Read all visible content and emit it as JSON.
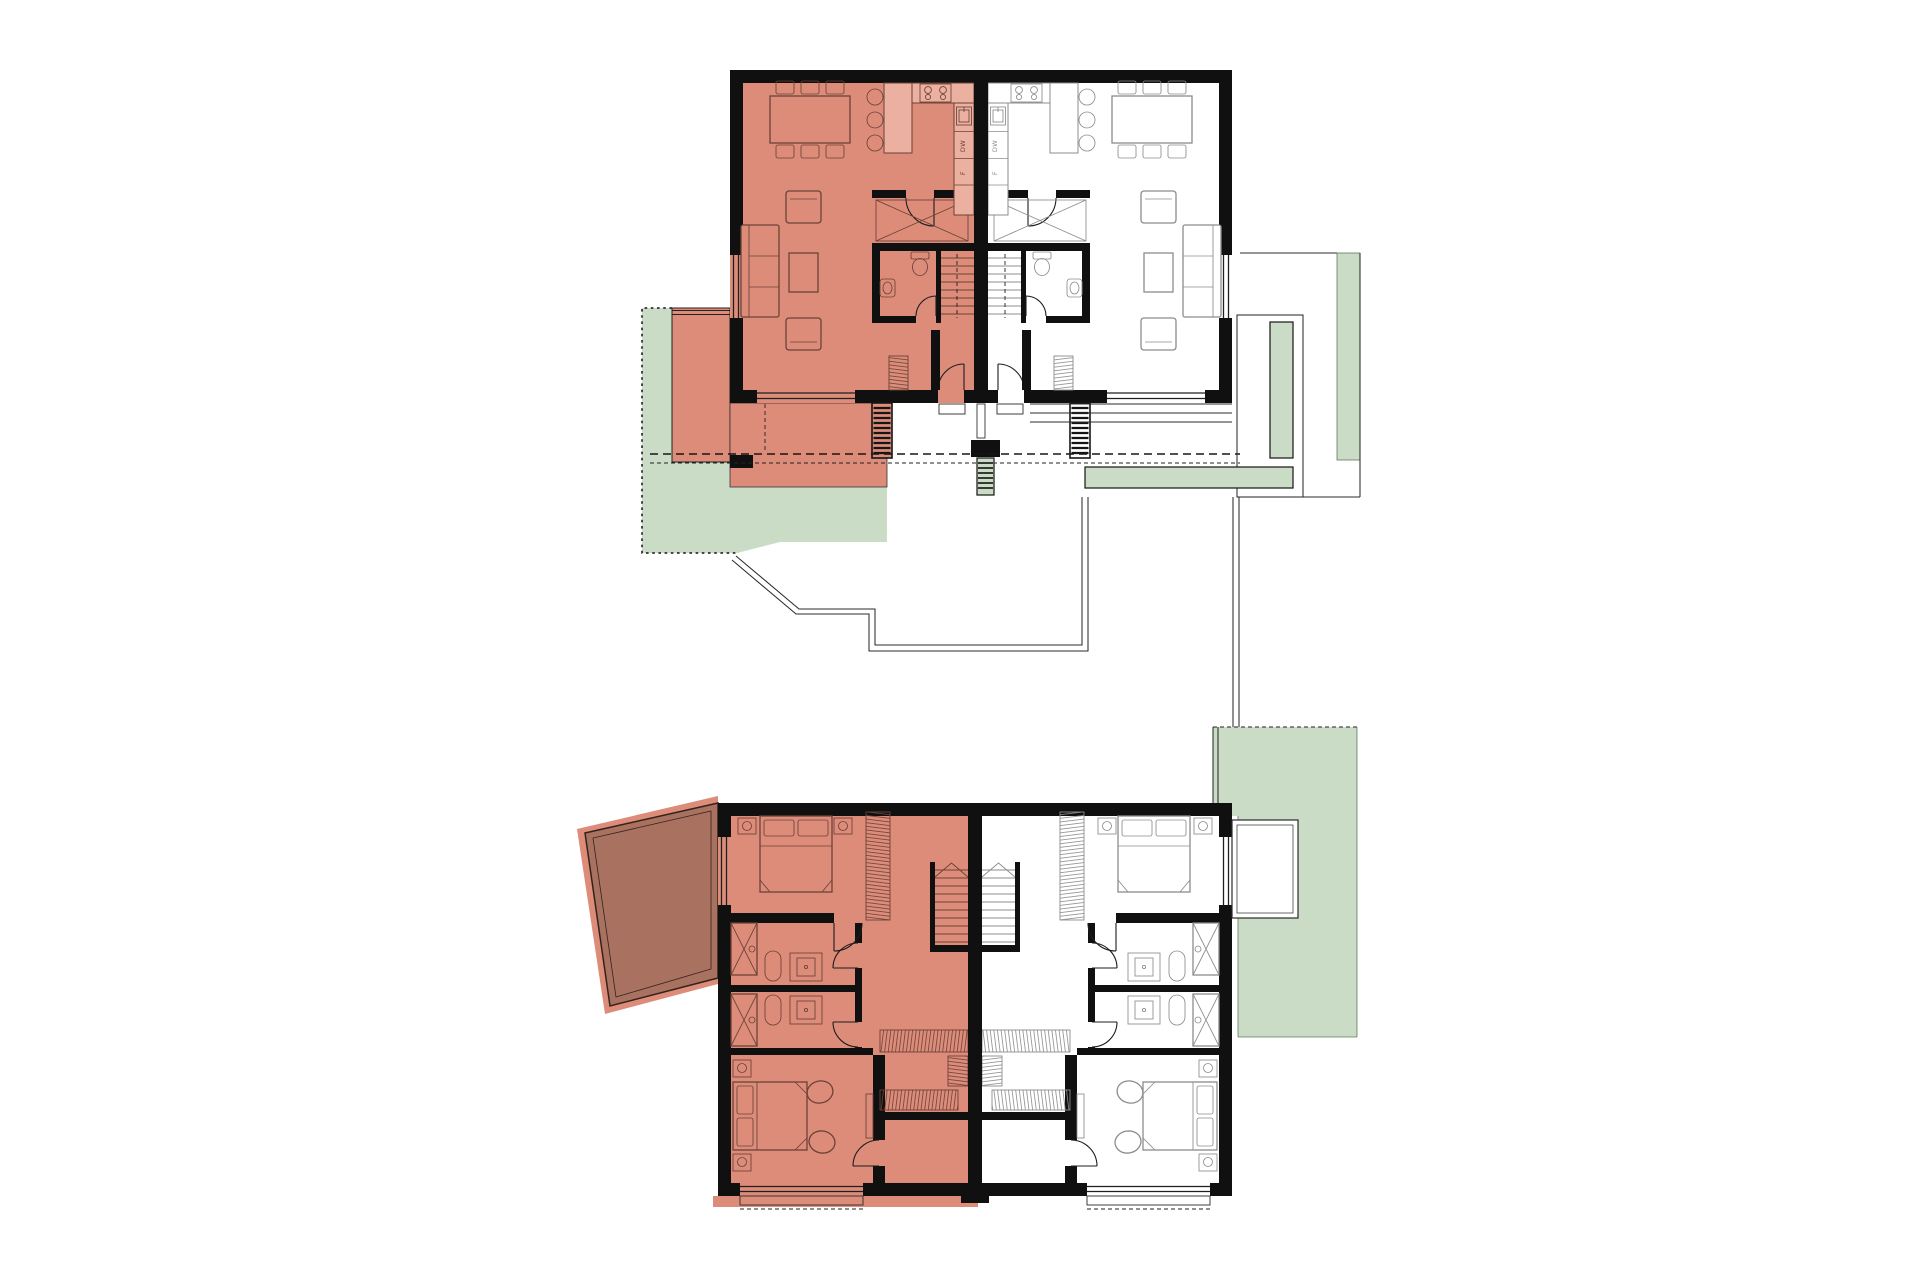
{
  "plans": [
    {
      "id": "ground-floor",
      "highlight": "left-unit"
    },
    {
      "id": "upper-floor",
      "highlight": "left-unit"
    }
  ],
  "labels": {
    "dishwasher": "DW",
    "fridge": "F"
  },
  "palette": {
    "salmon": "#DD8C7A",
    "salmon_line": "#6B4237",
    "salmon_cab": "#EBB0A0",
    "neutral_line": "#8C8C8C",
    "wall_c": "#101010",
    "glass_c": "#1F1F1F",
    "green_c": "#CBDCC6",
    "green_line": "#5F7A5C",
    "balcony_c": "#A9715F",
    "balcony_line": "#33221B",
    "site_c": "#2B2B2B",
    "bg": "#FFFFFF"
  }
}
